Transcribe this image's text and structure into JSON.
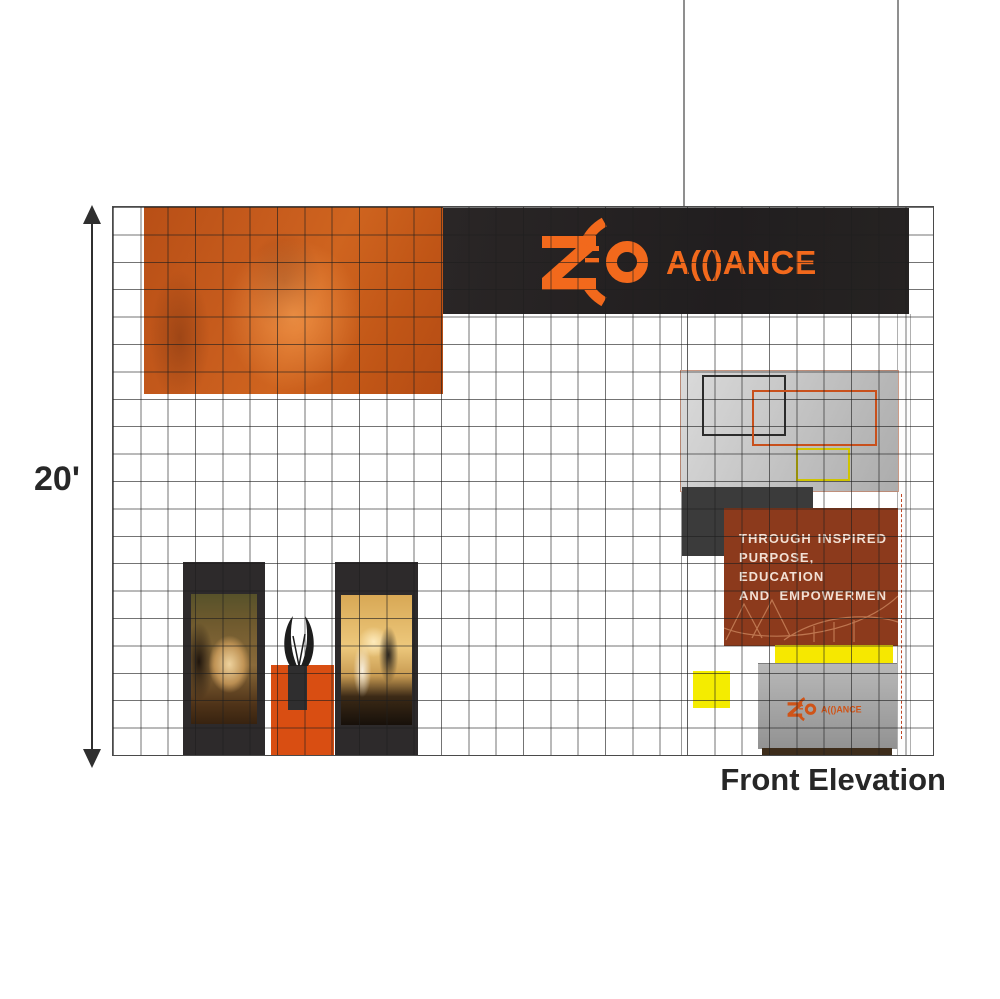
{
  "meta": {
    "view_label": "Front Elevation",
    "height_dimension": "20'"
  },
  "brand": {
    "name": "ZEO ALLIANCE",
    "wordmark_stylized": "A(()ANCE"
  },
  "backwall_message": {
    "lines": [
      "THROUGH INSPIRED",
      "PURPOSE, EDUCATION",
      "AND EMPOWERMEN"
    ]
  },
  "colors": {
    "logo_orange": "#f2691c",
    "photo_overlay_orange": "#c55a1f",
    "podium_orange": "#d94e12",
    "banner_black": "#252222",
    "message_rust": "#8c3a1c",
    "accent_yellow": "#f6e800",
    "structure_gray": "#b5b5b5",
    "grid_line": "#3c3c3c"
  }
}
